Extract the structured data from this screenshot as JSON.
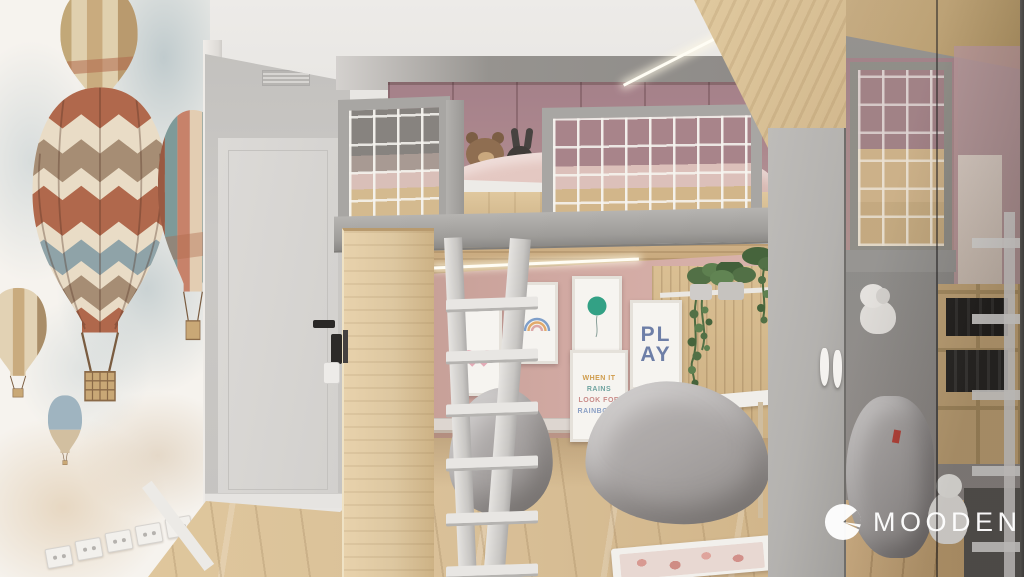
{
  "logo": {
    "text": "MOODEN"
  },
  "posters": {
    "quote": {
      "lines": [
        {
          "text": "WHEN IT"
        },
        {
          "text": "RAINS"
        },
        {
          "text": "LOOK FOR"
        },
        {
          "text": "RAINBOWS"
        }
      ]
    },
    "play": {
      "lines": [
        "PL",
        "AY"
      ]
    }
  },
  "colors": {
    "ceiling": "#e8e6e3",
    "mural": "#f6f3ee",
    "wall-gray": "#c6c4c1",
    "door": "#d9d7d4",
    "frame": "#a8a6a3",
    "beam": "#9e9c99",
    "wood": "#ddc7a0",
    "wood-dark": "#c7ab80",
    "floor": "#d9c098",
    "pink-wall": "#d1a9a2",
    "mauve": "#ac878d",
    "bedding": "#e3c7c1",
    "net": "#f3f1ed",
    "beanbag": "#aba7a6",
    "plant": "#4e6b42",
    "wardrobe": "#b4b2af",
    "mirror": "#868481",
    "led": "#fffdf4",
    "logo": "#ffffff",
    "tag-red": "#c03a2e",
    "heart": "#e4aab6",
    "balloon-teal": "#33a185",
    "play": "#5c6f9e",
    "q0": "#cf9b4a",
    "q1": "#6fa39f",
    "q2": "#c98b88",
    "q3": "#8a9fc4",
    "rust": "#b0684c",
    "cream": "#e9dcc6",
    "taupe": "#a68d74",
    "sky": "#8fa3a8"
  }
}
